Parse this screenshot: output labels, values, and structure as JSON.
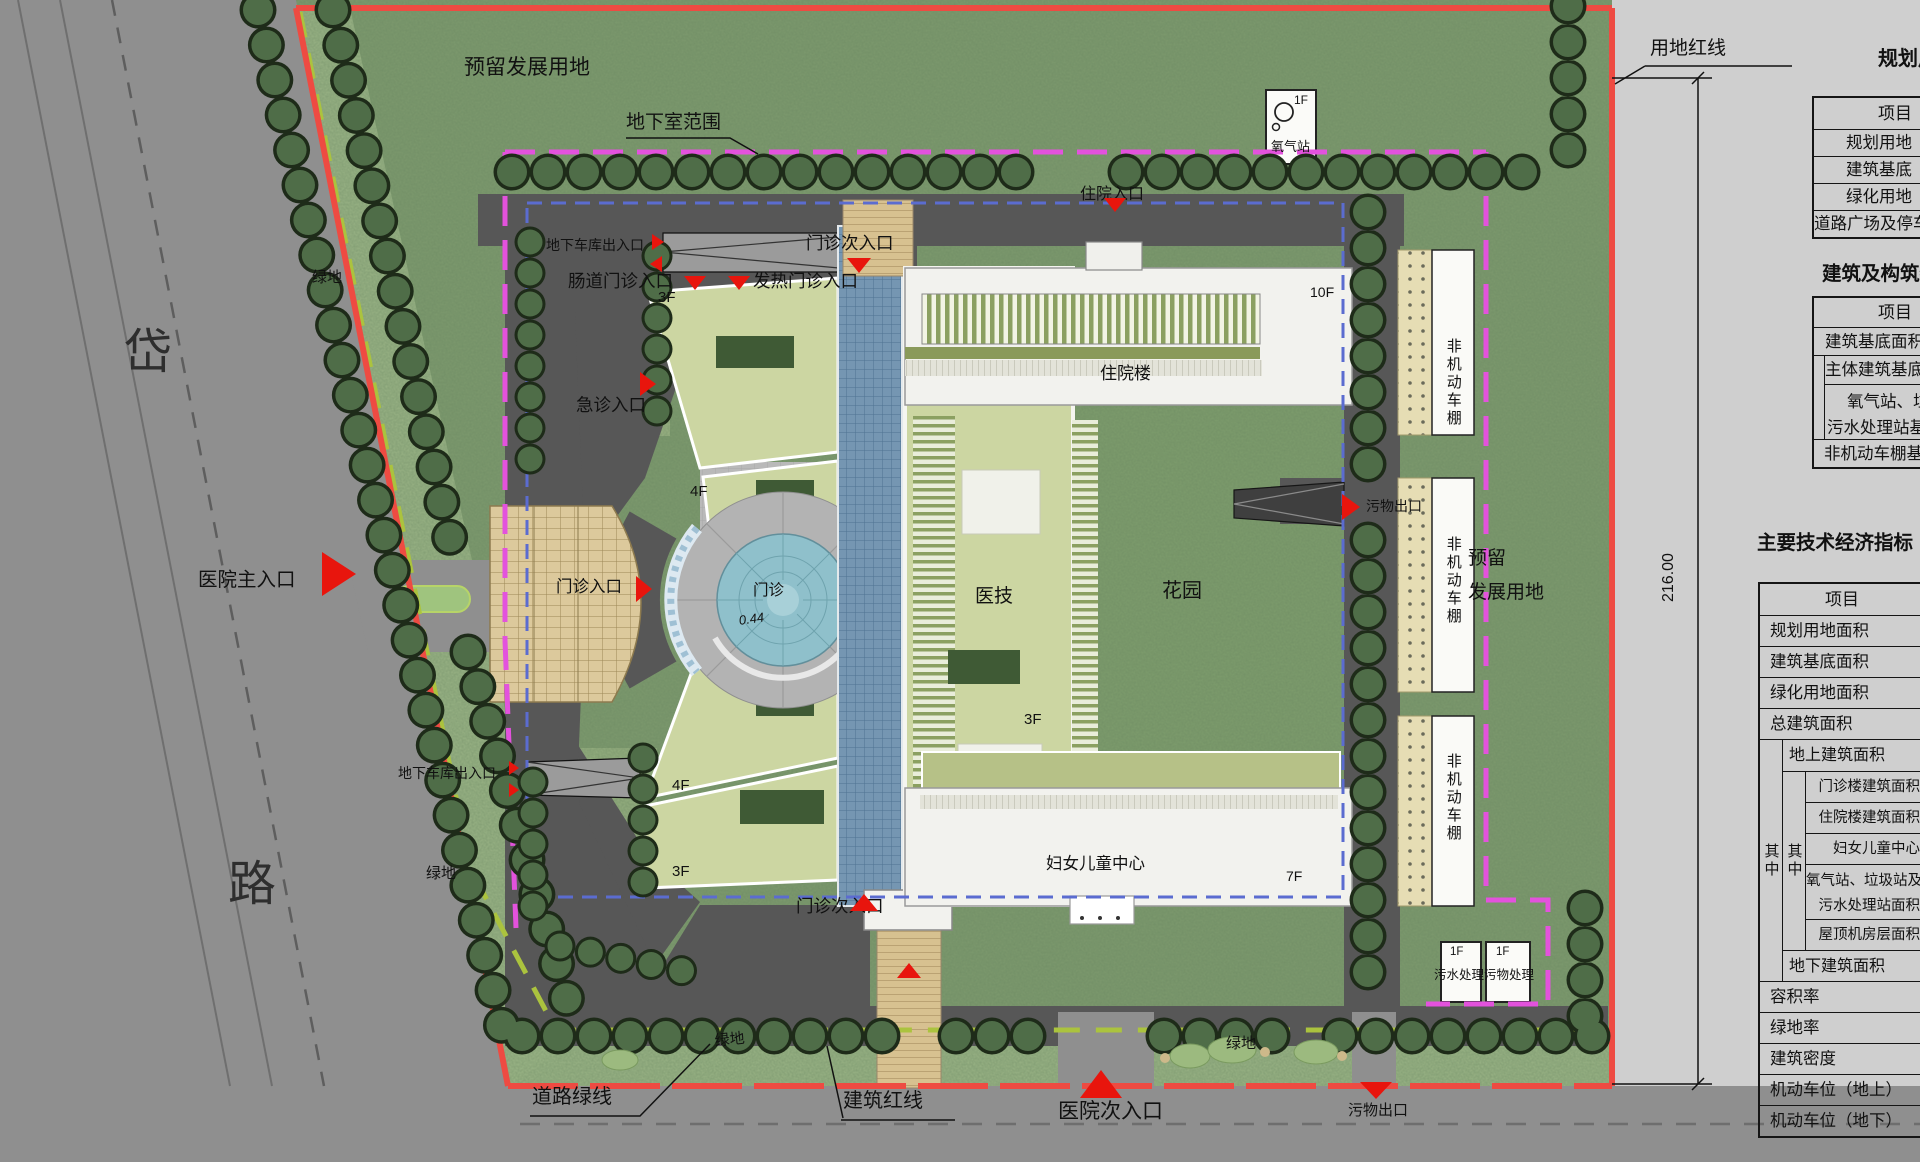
{
  "site_plan": {
    "colors": {
      "grass": "#7d9a6e",
      "road": "#8f8f8f",
      "inner_road": "#575757",
      "panel": "#cfcfcf",
      "red_line": "#ee4b42",
      "magenta_line": "#e352dd",
      "green_line": "#abc33e",
      "blue_line": "#5b6cd0",
      "marker": "#e8150d",
      "tree_outline": "#1e2b19",
      "tree_fill": "#4f6d48",
      "parking": "#dcc99c",
      "glass": "#7596b2",
      "wing": "#ccd6a2",
      "plaza_circle": "#8fc0cb"
    },
    "labels": [
      {
        "n": "label-reserved-land-top",
        "t": "预留发展用地",
        "x": 464,
        "y": 56,
        "fs": 21
      },
      {
        "n": "label-basement-extent",
        "t": "地下室范围",
        "x": 626,
        "y": 112,
        "fs": 19
      },
      {
        "n": "label-land-red-line",
        "t": "用地红线",
        "x": 1650,
        "y": 38,
        "fs": 19
      },
      {
        "n": "title-table-land-balance",
        "t": "规划用地",
        "x": 1878,
        "y": 48,
        "fs": 20,
        "b": 1
      },
      {
        "n": "title-table-structures",
        "t": "建筑及构筑物",
        "x": 1822,
        "y": 264,
        "fs": 19.5,
        "b": 1
      },
      {
        "n": "title-table-indicators",
        "t": "主要技术经济指标",
        "x": 1757,
        "y": 533,
        "fs": 19.5,
        "b": 1
      },
      {
        "n": "label-oxygen-station",
        "t": "氧气站",
        "x": 1271,
        "y": 140,
        "fs": 13
      },
      {
        "n": "label-oxygen-floors",
        "t": "1F",
        "x": 1294,
        "y": 94,
        "fs": 12
      },
      {
        "n": "label-inpatient-entrance",
        "t": "住院入口",
        "x": 1080,
        "y": 186,
        "fs": 16
      },
      {
        "n": "label-garage-entrance-top",
        "t": "地下车库出入口",
        "x": 546,
        "y": 238,
        "fs": 14
      },
      {
        "n": "label-intestinal-clinic-entrance",
        "t": "肠道门诊入口",
        "x": 568,
        "y": 272,
        "fs": 17.5
      },
      {
        "n": "label-fever-clinic-entrance",
        "t": "发热门诊入口",
        "x": 753,
        "y": 272,
        "fs": 17.5
      },
      {
        "n": "label-outpatient-secondary-entrance-top",
        "t": "门诊次入口",
        "x": 806,
        "y": 234,
        "fs": 17.5
      },
      {
        "n": "label-emergency-entrance",
        "t": "急诊入口",
        "x": 576,
        "y": 396,
        "fs": 17.5
      },
      {
        "n": "label-wing-3f-top",
        "t": "3F",
        "x": 658,
        "y": 290,
        "fs": 15
      },
      {
        "n": "label-wing-4f-top",
        "t": "4F",
        "x": 690,
        "y": 484,
        "fs": 15
      },
      {
        "n": "label-outpatient-entrance",
        "t": "门诊入口",
        "x": 556,
        "y": 578,
        "fs": 16.5
      },
      {
        "n": "label-outpatient-plaza",
        "t": "门诊",
        "x": 753,
        "y": 582,
        "fs": 15.5
      },
      {
        "n": "label-elevation",
        "t": "0.44",
        "x": 738,
        "y": 614,
        "fs": 13,
        "it": 1,
        "rot": -8
      },
      {
        "n": "label-medtech-building",
        "t": "医技",
        "x": 975,
        "y": 586,
        "fs": 19
      },
      {
        "n": "label-medtech-floors",
        "t": "3F",
        "x": 1024,
        "y": 712,
        "fs": 15
      },
      {
        "n": "label-garden",
        "t": "花园",
        "x": 1162,
        "y": 580,
        "fs": 20
      },
      {
        "n": "label-inpatient-building",
        "t": "住院楼",
        "x": 1100,
        "y": 364,
        "fs": 17
      },
      {
        "n": "label-inpatient-floors",
        "t": "10F",
        "x": 1310,
        "y": 285,
        "fs": 14
      },
      {
        "n": "label-waste-exit-east",
        "t": "污物出口",
        "x": 1366,
        "y": 499,
        "fs": 14
      },
      {
        "n": "label-bike-shed-1",
        "t": "非机动车棚",
        "x": 1444,
        "y": 338,
        "fs": 15,
        "vert": 1
      },
      {
        "n": "label-bike-shed-2",
        "t": "非机动车棚",
        "x": 1444,
        "y": 536,
        "fs": 15,
        "vert": 1
      },
      {
        "n": "label-bike-shed-3",
        "t": "非机动车棚",
        "x": 1444,
        "y": 753,
        "fs": 15,
        "vert": 1
      },
      {
        "n": "label-reserved-land-east-1",
        "t": "预留",
        "x": 1468,
        "y": 548,
        "fs": 19
      },
      {
        "n": "label-reserved-land-east-2",
        "t": "发展用地",
        "x": 1468,
        "y": 582,
        "fs": 19
      },
      {
        "n": "label-dimension",
        "t": "216.00",
        "x": 1660,
        "y": 602,
        "fs": 16,
        "rot": -90
      },
      {
        "n": "label-wing-4f-bottom",
        "t": "4F",
        "x": 672,
        "y": 778,
        "fs": 15
      },
      {
        "n": "label-wing-3f-bottom",
        "t": "3F",
        "x": 672,
        "y": 864,
        "fs": 15
      },
      {
        "n": "label-outpatient-secondary-entrance-bottom",
        "t": "门诊次入口",
        "x": 796,
        "y": 897,
        "fs": 17.5
      },
      {
        "n": "label-women-children-center",
        "t": "妇女儿童中心",
        "x": 1046,
        "y": 855,
        "fs": 16.5
      },
      {
        "n": "label-wcc-floors",
        "t": "7F",
        "x": 1286,
        "y": 869,
        "fs": 14
      },
      {
        "n": "label-garage-entrance-bottom",
        "t": "地下车库出入口",
        "x": 398,
        "y": 766,
        "fs": 14
      },
      {
        "n": "label-green-west",
        "t": "绿地",
        "x": 312,
        "y": 270,
        "fs": 15
      },
      {
        "n": "label-green-southwest",
        "t": "绿地",
        "x": 426,
        "y": 866,
        "fs": 15
      },
      {
        "n": "label-green-south-1",
        "t": "绿地",
        "x": 714,
        "y": 1034,
        "fs": 15,
        "rot": -6
      },
      {
        "n": "label-green-south-2",
        "t": "绿地",
        "x": 1226,
        "y": 1036,
        "fs": 15
      },
      {
        "n": "label-road-green-line",
        "t": "道路绿线",
        "x": 532,
        "y": 1086,
        "fs": 20
      },
      {
        "n": "label-building-red-line",
        "t": "建筑红线",
        "x": 843,
        "y": 1090,
        "fs": 20
      },
      {
        "n": "label-hospital-secondary-entrance",
        "t": "医院次入口",
        "x": 1058,
        "y": 1100,
        "fs": 21
      },
      {
        "n": "label-waste-exit-south",
        "t": "污物出口",
        "x": 1348,
        "y": 1103,
        "fs": 15
      },
      {
        "n": "label-hospital-main-entrance",
        "t": "医院主入口",
        "x": 198,
        "y": 570,
        "fs": 19.5
      },
      {
        "n": "label-road-name-1",
        "t": "岱",
        "x": 124,
        "y": 326,
        "fs": 48,
        "c": "#2e2e2e"
      },
      {
        "n": "label-road-name-2",
        "t": "路",
        "x": 228,
        "y": 858,
        "fs": 48,
        "c": "#2e2e2e"
      },
      {
        "n": "label-sewage-plant",
        "t": "污水处理",
        "x": 1434,
        "y": 968,
        "fs": 12.5
      },
      {
        "n": "label-sewage-floors",
        "t": "1F",
        "x": 1450,
        "y": 946,
        "fs": 11.5
      },
      {
        "n": "label-waste-plant",
        "t": "污物处理",
        "x": 1484,
        "y": 968,
        "fs": 12.5
      },
      {
        "n": "label-waste-floors",
        "t": "1F",
        "x": 1496,
        "y": 946,
        "fs": 11.5
      }
    ],
    "markers": [
      {
        "name": "marker-hospital-main-entrance",
        "x": 322,
        "y": 552,
        "dir": "right",
        "w": 34,
        "h": 44
      },
      {
        "name": "marker-garage-top-a",
        "x": 652,
        "y": 234,
        "dir": "right",
        "w": 12,
        "h": 16
      },
      {
        "name": "marker-garage-top-b",
        "x": 650,
        "y": 256,
        "dir": "left",
        "w": 12,
        "h": 16
      },
      {
        "name": "marker-intestinal-entrance",
        "x": 684,
        "y": 276,
        "dir": "down",
        "w": 22,
        "h": 14
      },
      {
        "name": "marker-fever-entrance",
        "x": 728,
        "y": 276,
        "dir": "down",
        "w": 22,
        "h": 14
      },
      {
        "name": "marker-outpatient-secondary-top",
        "x": 847,
        "y": 258,
        "dir": "down",
        "w": 24,
        "h": 15
      },
      {
        "name": "marker-inpatient-entrance",
        "x": 1104,
        "y": 198,
        "dir": "down",
        "w": 22,
        "h": 14
      },
      {
        "name": "marker-emergency-entrance",
        "x": 640,
        "y": 372,
        "dir": "right",
        "w": 16,
        "h": 24
      },
      {
        "name": "marker-outpatient-entrance",
        "x": 636,
        "y": 576,
        "dir": "right",
        "w": 16,
        "h": 26
      },
      {
        "name": "marker-waste-exit-east",
        "x": 1342,
        "y": 494,
        "dir": "right",
        "w": 18,
        "h": 26
      },
      {
        "name": "marker-garage-bottom-a",
        "x": 509,
        "y": 761,
        "dir": "right",
        "w": 10,
        "h": 14
      },
      {
        "name": "marker-garage-bottom-b",
        "x": 509,
        "y": 783,
        "dir": "right",
        "w": 10,
        "h": 14
      },
      {
        "name": "marker-outpatient-secondary-bottom",
        "x": 850,
        "y": 894,
        "dir": "up",
        "w": 28,
        "h": 17
      },
      {
        "name": "marker-walkway",
        "x": 897,
        "y": 963,
        "dir": "up",
        "w": 24,
        "h": 15
      },
      {
        "name": "marker-hospital-secondary-entrance",
        "x": 1080,
        "y": 1070,
        "dir": "up",
        "w": 42,
        "h": 28
      },
      {
        "name": "marker-waste-exit-south",
        "x": 1360,
        "y": 1082,
        "dir": "down",
        "w": 32,
        "h": 17
      }
    ],
    "tables": {
      "t1": {
        "header": "项目",
        "rows": [
          "规划用地",
          "建筑基底",
          "绿化用地",
          "道路广场及停车"
        ]
      },
      "t2": {
        "header": "项目",
        "row_base": "建筑基底面积",
        "row_main": "主体建筑基底",
        "two_line_1": "氧气站、垃圾站及",
        "two_line_2": "污水处理站基底",
        "row_shed": "非机动车棚基底"
      },
      "t3": {
        "header": "项目",
        "top_rows": [
          "规划用地面积",
          "建筑基底面积",
          "绿化用地面积",
          "总建筑面积"
        ],
        "qizhong": "其中",
        "row_above_ground": "地上建筑面积",
        "inner_rows": [
          "门诊楼建筑面积",
          "住院楼建筑面积",
          "妇女儿童中心"
        ],
        "inner_two_line_1": "氧气站、垃圾站及",
        "inner_two_line_2": "污水处理站面积",
        "inner_last": "屋顶机房层面积",
        "row_below_ground": "地下建筑面积",
        "bottom_rows": [
          "容积率",
          "绿地率",
          "建筑密度",
          "机动车位（地上）",
          "机动车位（地下）"
        ]
      }
    }
  }
}
